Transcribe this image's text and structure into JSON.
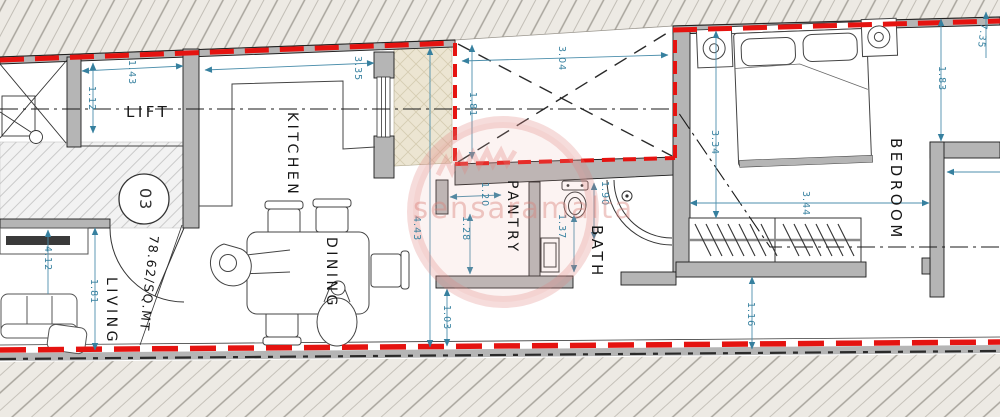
{
  "plan": {
    "unit_number": "03",
    "area_label": "78.62/SQ.MT",
    "watermark_text": "sensaramalta",
    "rooms": {
      "lift": "LIFT",
      "kitchen": "KITCHEN",
      "dining": "DINING",
      "living": "LIVING",
      "pantry": "PANTRY",
      "bath": "BATH",
      "bedroom": "BEDROOM"
    },
    "dims": {
      "lift_width": "1.43",
      "lift_depth": "1.12",
      "kitchen_width": "3.35",
      "shaft_width": "3.04",
      "shaft_depth": "1.81",
      "living_length": "4.12",
      "living_depth": "1.81",
      "dining_length": "4.43",
      "pantry_width": "1.20",
      "pantry_depth": "1.28",
      "bath_width": "1.37",
      "bath_depth": "1.90",
      "corridor": "1.03",
      "bedroom_length": "7.35",
      "bedroom_offset": "1.83",
      "bedroom_depth": "3.34",
      "wardrobe_width": "3.44",
      "wardrobe_clear": "1.16"
    },
    "colors": {
      "boundary_red": "#e51310",
      "dimension_teal": "#36809f",
      "wall_gray": "#b5b5b5",
      "exterior_beige": "#edeae4",
      "shaft_beige": "#ece5d2",
      "watermark_pink": "#d8807a"
    }
  }
}
